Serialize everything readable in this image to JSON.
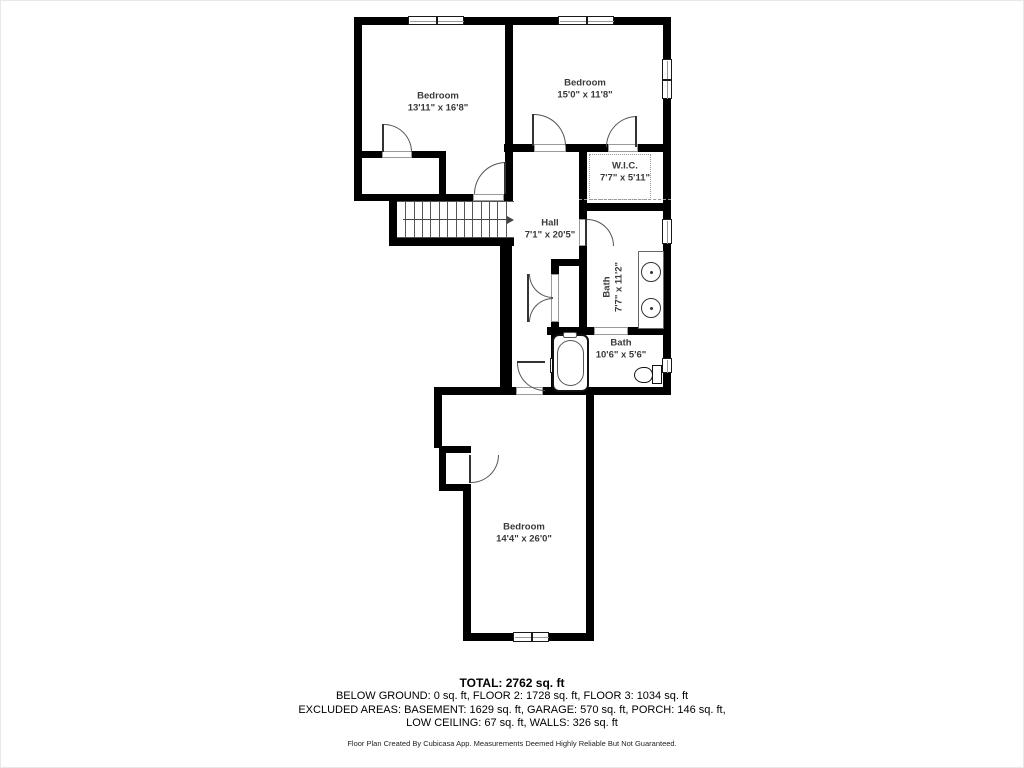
{
  "page": {
    "background": "#ffffff",
    "wall_color": "#000000",
    "label_color": "#3a3a3a"
  },
  "floorplan": {
    "rooms": [
      {
        "id": "bedroom-top-left",
        "name": "Bedroom",
        "dims": "13'11\" x 16'8\"",
        "cx": 437,
        "cy": 101,
        "rot": 0
      },
      {
        "id": "bedroom-top-right",
        "name": "Bedroom",
        "dims": "15'0\" x 11'8\"",
        "cx": 584,
        "cy": 88,
        "rot": 0
      },
      {
        "id": "walk-in-closet",
        "name": "W.I.C.",
        "dims": "7'7\" x 5'11\"",
        "cx": 624,
        "cy": 171,
        "rot": 0
      },
      {
        "id": "hall",
        "name": "Hall",
        "dims": "7'1\" x 20'5\"",
        "cx": 549,
        "cy": 228,
        "rot": 0
      },
      {
        "id": "bath-main",
        "name": "Bath",
        "dims": "7'7\" x 11'2\"",
        "cx": 612,
        "cy": 286,
        "rot": -90
      },
      {
        "id": "bath-small",
        "name": "Bath",
        "dims": "10'6\" x 5'6\"",
        "cx": 620,
        "cy": 348,
        "rot": 0
      },
      {
        "id": "bedroom-bottom",
        "name": "Bedroom",
        "dims": "14'4\" x 26'0\"",
        "cx": 523,
        "cy": 532,
        "rot": 0
      }
    ],
    "walls": [
      [
        353,
        16,
        317,
        8
      ],
      [
        353,
        16,
        8,
        184
      ],
      [
        504,
        16,
        8,
        187
      ],
      [
        503,
        143,
        167,
        8
      ],
      [
        353,
        150,
        92,
        7
      ],
      [
        438,
        150,
        7,
        50
      ],
      [
        353,
        193,
        159,
        7
      ],
      [
        388,
        200,
        8,
        45
      ],
      [
        388,
        237,
        125,
        8
      ],
      [
        499,
        245,
        12,
        141
      ],
      [
        578,
        202,
        92,
        8
      ],
      [
        578,
        150,
        8,
        184
      ],
      [
        550,
        258,
        36,
        7
      ],
      [
        550,
        258,
        8,
        136
      ],
      [
        546,
        326,
        124,
        8
      ],
      [
        545,
        386,
        125,
        8
      ],
      [
        433,
        386,
        117,
        8
      ],
      [
        433,
        386,
        8,
        61
      ],
      [
        438,
        445,
        32,
        7
      ],
      [
        438,
        445,
        7,
        45
      ],
      [
        438,
        483,
        32,
        7
      ],
      [
        462,
        483,
        8,
        155
      ],
      [
        462,
        632,
        131,
        8
      ],
      [
        585,
        394,
        8,
        246
      ],
      [
        662,
        16,
        8,
        378
      ]
    ],
    "windows": [
      {
        "x": 407,
        "y": 15,
        "w": 56,
        "h": 9,
        "panes": 2
      },
      {
        "x": 557,
        "y": 15,
        "w": 56,
        "h": 9,
        "panes": 2
      },
      {
        "x": 661,
        "y": 58,
        "w": 10,
        "h": 40,
        "panes": 2
      },
      {
        "x": 661,
        "y": 218,
        "w": 10,
        "h": 25,
        "panes": 1
      },
      {
        "x": 661,
        "y": 357,
        "w": 10,
        "h": 15,
        "panes": 1
      },
      {
        "x": 512,
        "y": 631,
        "w": 36,
        "h": 10,
        "panes": 2
      },
      {
        "x": 549,
        "y": 357,
        "w": 10,
        "h": 15,
        "panes": 1
      }
    ],
    "door_openings": [
      [
        381,
        150,
        30,
        7
      ],
      [
        472,
        193,
        31,
        7
      ],
      [
        533,
        143,
        32,
        8
      ],
      [
        607,
        143,
        30,
        8
      ],
      [
        578,
        218,
        8,
        27
      ],
      [
        515,
        386,
        27,
        8
      ],
      [
        593,
        326,
        34,
        8
      ],
      [
        550,
        273,
        8,
        48
      ]
    ],
    "doors": [
      {
        "x": 383,
        "y": 123,
        "s": 28,
        "c": "tr",
        "leaf": [
          381,
          123,
          2,
          28
        ]
      },
      {
        "x": 473,
        "y": 161,
        "s": 32,
        "c": "tl",
        "leaf": [
          503,
          161,
          2,
          32
        ]
      },
      {
        "x": 533,
        "y": 113,
        "s": 32,
        "c": "tr",
        "leaf": [
          531,
          113,
          2,
          32
        ]
      },
      {
        "x": 605,
        "y": 115,
        "s": 31,
        "c": "tl",
        "leaf": [
          634,
          115,
          2,
          31
        ]
      },
      {
        "x": 586,
        "y": 218,
        "s": 27,
        "c": "tr",
        "leaf": [
          584,
          218,
          2,
          27
        ]
      },
      {
        "x": 528,
        "y": 273,
        "s": 24,
        "c": "bl",
        "leaf": [
          526,
          273,
          2,
          24
        ]
      },
      {
        "x": 528,
        "y": 297,
        "s": 24,
        "c": "tl",
        "leaf": [
          526,
          297,
          2,
          24
        ]
      },
      {
        "x": 516,
        "y": 362,
        "s": 28,
        "c": "bl",
        "leaf": [
          516,
          360,
          28,
          2
        ]
      },
      {
        "x": 470,
        "y": 454,
        "s": 28,
        "c": "br",
        "leaf": [
          468,
          454,
          2,
          28
        ]
      }
    ],
    "stairs": {
      "x": 396,
      "y": 200,
      "w": 117,
      "h": 37,
      "treads": 13,
      "arrow_y": 18
    },
    "fixtures": [
      {
        "type": "vanity",
        "x": 637,
        "y": 250,
        "w": 26,
        "h": 78
      },
      {
        "type": "sink",
        "x": 640,
        "y": 261,
        "w": 20,
        "h": 20
      },
      {
        "type": "sink",
        "x": 640,
        "y": 297,
        "w": 20,
        "h": 20
      },
      {
        "type": "tub",
        "x": 551,
        "y": 333,
        "w": 37,
        "h": 58
      },
      {
        "type": "tub-faucet",
        "x": 562,
        "y": 331,
        "w": 14,
        "h": 6
      },
      {
        "type": "toilet-tank",
        "x": 651,
        "y": 364,
        "w": 10,
        "h": 19
      },
      {
        "type": "toilet-bowl",
        "x": 633,
        "y": 366,
        "w": 19,
        "h": 16
      },
      {
        "type": "wic-dotted",
        "x": 588,
        "y": 153,
        "w": 62,
        "h": 46
      },
      {
        "type": "dash-line",
        "x": 578,
        "y": 198,
        "w": 92,
        "h": 1
      }
    ]
  },
  "footer": {
    "total": "TOTAL: 2762 sq. ft",
    "line2": "BELOW GROUND: 0 sq. ft, FLOOR 2: 1728 sq. ft, FLOOR 3: 1034 sq. ft",
    "line3": "EXCLUDED AREAS: BASEMENT: 1629 sq. ft, GARAGE: 570 sq. ft, PORCH: 146 sq. ft,",
    "line4": "LOW CEILING: 67 sq. ft, WALLS: 326 sq. ft",
    "disclaimer": "Floor Plan Created By Cubicasa App. Measurements Deemed Highly Reliable But Not Guaranteed."
  }
}
